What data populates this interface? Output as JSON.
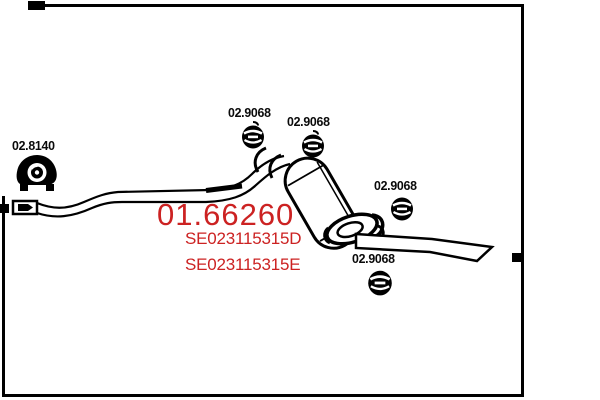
{
  "page": {
    "background": "#ffffff",
    "ink": "#000000",
    "accent": "#cc2222",
    "description": "Exhaust rear silencer technical diagram"
  },
  "part": {
    "mts_code": "01.66260",
    "oem_codes": [
      "SE023115315D",
      "SE023115315E"
    ]
  },
  "related_parts": [
    {
      "code": "02.8140",
      "icon": "rubber-hanger-icon"
    },
    {
      "code": "02.9068",
      "icon": "pipe-clamp-icon"
    },
    {
      "code": "02.9068",
      "icon": "pipe-clamp-icon"
    },
    {
      "code": "02.9068",
      "icon": "pipe-clamp-icon"
    },
    {
      "code": "02.9068",
      "icon": "pipe-clamp-icon"
    }
  ]
}
